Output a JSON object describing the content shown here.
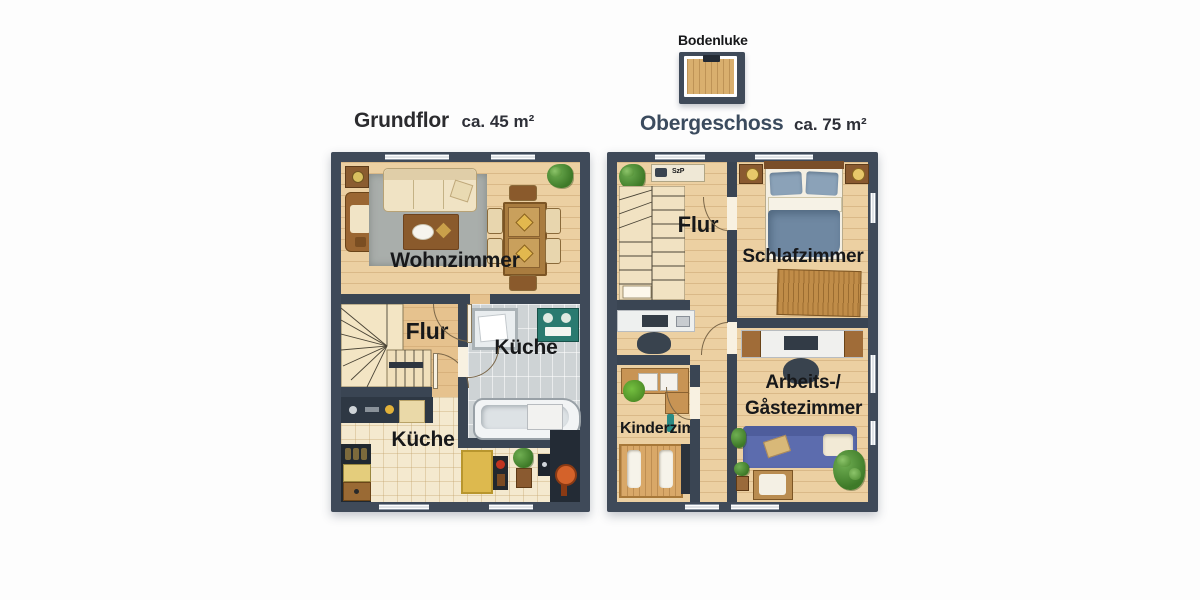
{
  "attic": {
    "label": "Bodenluke"
  },
  "floors": {
    "ground": {
      "title": "Grundflor",
      "area": "ca. 45 m²",
      "rooms": {
        "living": "Wohnzimmer",
        "hall": "Flur",
        "bath": "Küche",
        "kitchen": "Küche"
      }
    },
    "upper": {
      "title": "Obergeschoss",
      "area": "ca. 75 m²",
      "shelf_label": "SzP",
      "rooms": {
        "hall": "Flur",
        "bedroom": "Schlafzimmer",
        "office1": "Arbeits-/",
        "office2": "Gåstezimmer",
        "kids": "Kinderzimmer"
      }
    }
  },
  "colors": {
    "wall": "#3f4a59",
    "wood": "#ecd0a2",
    "bath_tile": "#ced3d5",
    "kitchen_tile": "#f4e9cf",
    "bed_blue": "#6f88a2",
    "sofa_blue": "#5c6cae",
    "teal": "#2a7a70"
  }
}
